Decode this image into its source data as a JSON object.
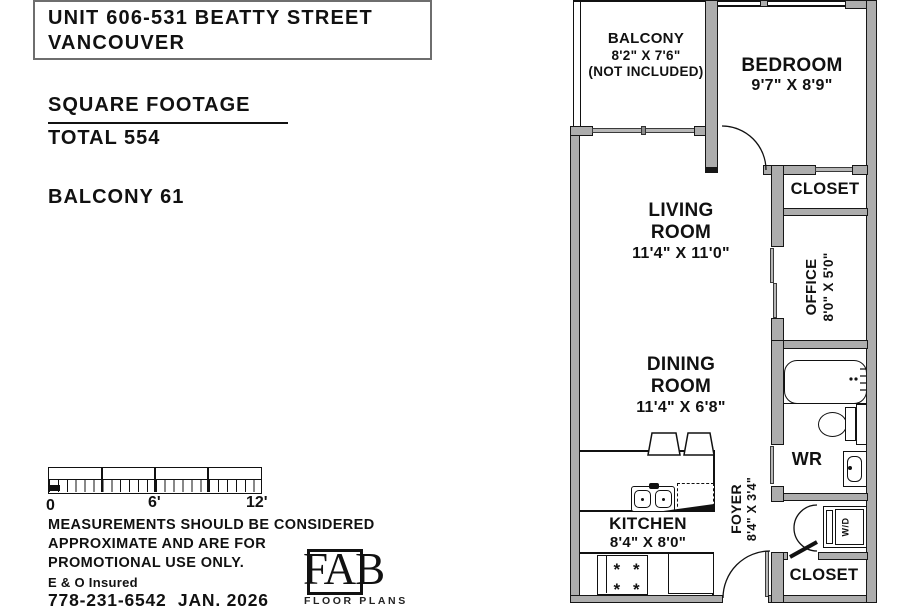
{
  "window": {
    "width": 910,
    "height": 606
  },
  "info_panel": {
    "title_line1": "UNIT 606-531 BEATTY STREET",
    "title_line2": "VANCOUVER",
    "sf_heading": "SQUARE FOOTAGE",
    "sf_total": "TOTAL 554",
    "sf_balcony": "BALCONY 61",
    "scale_labels": [
      "0",
      "6'",
      "12'"
    ],
    "disclaimer_line1": "MEASUREMENTS SHOULD BE CONSIDERED",
    "disclaimer_line2": "APPROXIMATE AND ARE FOR",
    "disclaimer_line3": "PROMOTIONAL USE ONLY.",
    "insured": "E & O Insured",
    "phone_date": "778-231-6542  JAN. 2026",
    "logo_text": "FAB",
    "logo_sub": "FLOOR PLANS"
  },
  "floorplan": {
    "balcony": [
      "BALCONY",
      "8'2\" X 7'6\"",
      "(NOT INCLUDED)"
    ],
    "bedroom": [
      "BEDROOM",
      "9'7\" X 8'9\""
    ],
    "closet_top": "CLOSET",
    "living": [
      "LIVING",
      "ROOM",
      "11'4\" X 11'0\""
    ],
    "office": [
      "OFFICE",
      "8'0\" X 5'0\""
    ],
    "dining": [
      "DINING",
      "ROOM",
      "11'4\" X 6'8\""
    ],
    "wr": "WR",
    "kitchen": [
      "KITCHEN",
      "8'4\" X 8'0\""
    ],
    "foyer": [
      "FOYER",
      "8'4\" X 3'4\""
    ],
    "wd": "W/D",
    "closet_bottom": "CLOSET"
  },
  "colors": {
    "wall_fill": "#adadad",
    "outline": "#111111",
    "background": "#ffffff"
  }
}
